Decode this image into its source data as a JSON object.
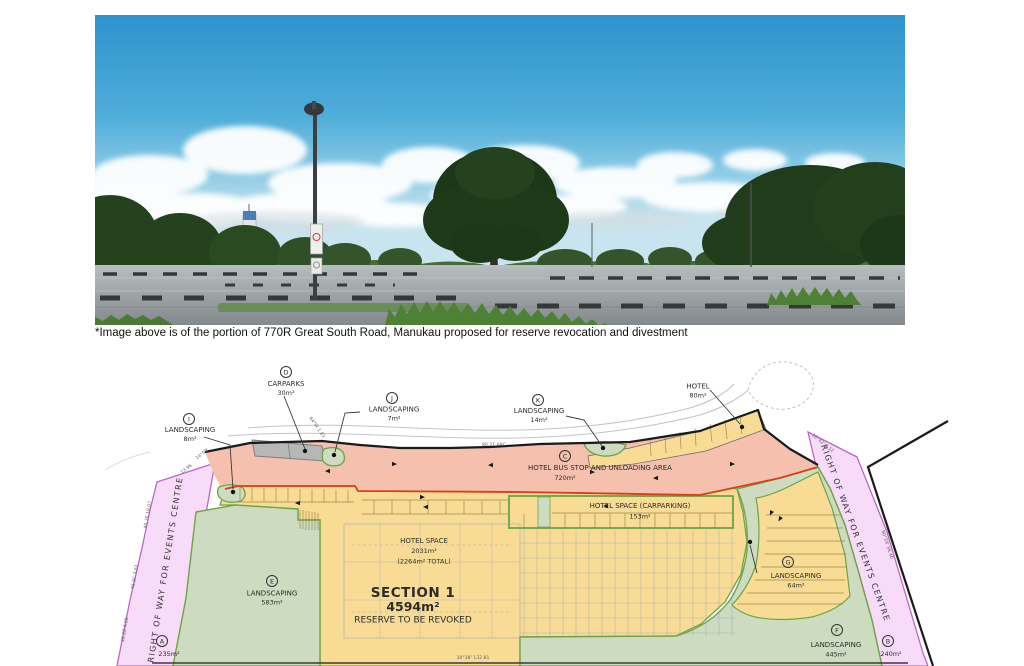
{
  "document": {
    "caption": "*Image above is of the portion of 770R Great South Road, Manukau proposed for reserve revocation and divestment"
  },
  "photo": {
    "description": "empty car park with trees, light pole and blue cloudy sky"
  },
  "plan": {
    "labels": {
      "d_letter": "D",
      "d_name": "CARPARKS",
      "d_area": "30m²",
      "i_letter": "I",
      "i_name": "LANDSCAPING",
      "i_area": "8m²",
      "j_letter": "J",
      "j_name": "LANDSCAPING",
      "j_area": "7m²",
      "k_letter": "K",
      "k_name": "LANDSCAPING",
      "k_area": "14m²",
      "hotel_name": "HOTEL",
      "hotel_area": "80m²",
      "c_letter": "C",
      "c_name": "HOTEL BUS STOP AND UNLOADING AREA",
      "c_area": "720m²",
      "hsc_name": "HOTEL SPACE (CARPARKING)",
      "hsc_area": "153m²",
      "hs_name": "HOTEL SPACE",
      "hs_area": "2031m²",
      "hs_total": "(2264m² TOTAL)",
      "section_title": "SECTION 1",
      "section_area": "4594m²",
      "section_note": "RESERVE TO BE REVOKED",
      "e_letter": "E",
      "e_name": "LANDSCAPING",
      "e_area": "583m²",
      "g_letter": "G",
      "g_name": "LANDSCAPING",
      "g_area": "64m²",
      "f_letter": "F",
      "f_name": "LANDSCAPING",
      "f_area": "445m²",
      "a_letter": "A",
      "a_area": "235m²",
      "b_letter": "B",
      "b_area": "240m²",
      "row_left": "RIGHT OF WAY FOR EVENTS CENTRE",
      "row_right": "RIGHT OF WAY FOR EVENTS CENTRE"
    },
    "bearings": {
      "top": "86.21 ARC",
      "bottom": "30°38' 132.81",
      "l1": "45.7E 18.07",
      "l2": "46.5C 3.61",
      "l3": "40.28 4.28",
      "l4": "13.96",
      "l5": "14°50'",
      "l6": "64°W 1.83",
      "r1": "16°42' 8.12",
      "r2": "90°39' 36.46"
    },
    "colors": {
      "bus_stop_area": "#f5c0ae",
      "hotel_space_area": "#f8dc95",
      "landscaping_area": "#cddcc1",
      "landscaping_stroke": "#6fa344",
      "right_of_way_area": "#f8dbf8",
      "right_of_way_stroke": "#bb68c4",
      "carparks_area": "#b7b7b7",
      "revoke_boundary": "#d2411c"
    }
  }
}
